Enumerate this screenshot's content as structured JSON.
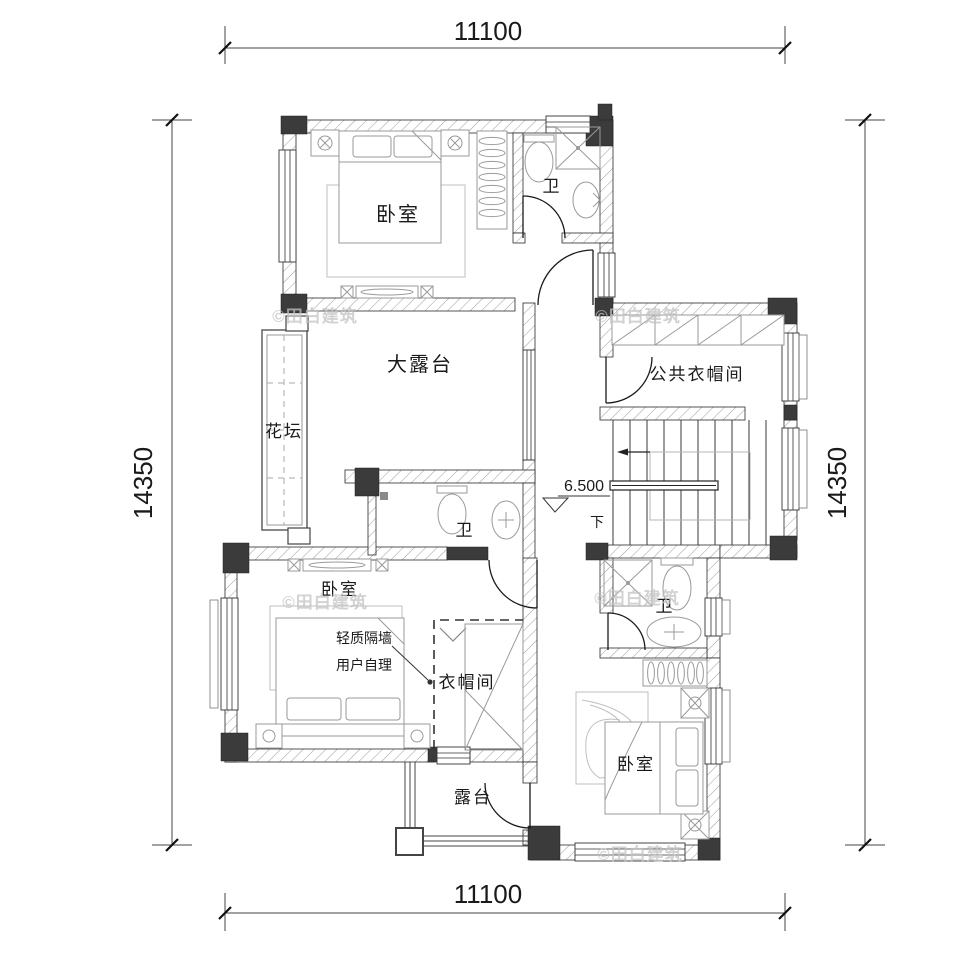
{
  "dimensions": {
    "top": "11100",
    "bottom": "11100",
    "left": "14350",
    "right": "14350"
  },
  "rooms": {
    "bedroom_top_left": "卧室",
    "bath_top": "卫",
    "large_terrace": "大露台",
    "flower_bed": "花坛",
    "public_cloakroom": "公共衣帽间",
    "bath_middle": "卫",
    "bedroom_mid_left": "卧室",
    "cloakroom": "衣帽间",
    "bath_right": "卫",
    "bedroom_bottom_right": "卧室",
    "terrace": "露台"
  },
  "annotations": {
    "elevation": "6.500",
    "stair_direction": "下",
    "partition_note_line1": "轻质隔墙",
    "partition_note_line2": "用户自理",
    "watermark": "©田白建筑"
  },
  "colors": {
    "wall_column": "#3b3b3b",
    "line": "#1a1a1a",
    "furniture": "#9a9a9a",
    "watermark": "#c3c3c3"
  }
}
